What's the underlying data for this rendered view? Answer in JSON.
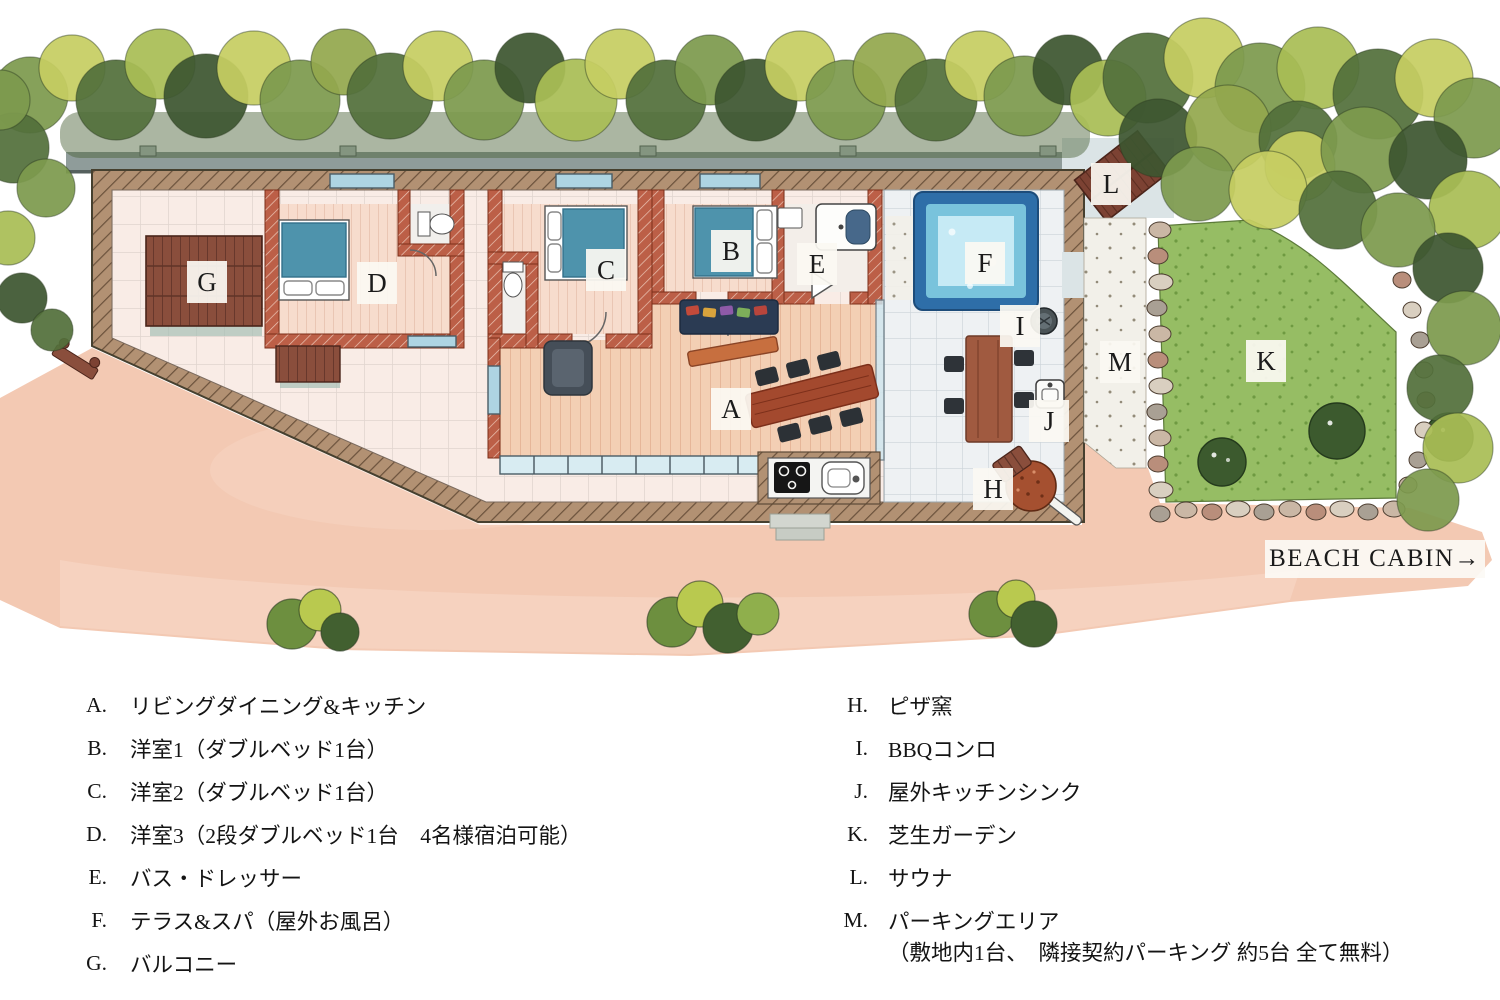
{
  "plan": {
    "labels": [
      {
        "letter": "A"
      },
      {
        "letter": "B"
      },
      {
        "letter": "C"
      },
      {
        "letter": "D"
      },
      {
        "letter": "E"
      },
      {
        "letter": "F"
      },
      {
        "letter": "G"
      },
      {
        "letter": "H"
      },
      {
        "letter": "I"
      },
      {
        "letter": "J"
      },
      {
        "letter": "K"
      },
      {
        "letter": "L"
      },
      {
        "letter": "M"
      }
    ],
    "beach_cabin": "BEACH CABIN→"
  },
  "legend": {
    "left": [
      {
        "letter": "A.",
        "text": "リビングダイニング&キッチン"
      },
      {
        "letter": "B.",
        "text": "洋室1（ダブルベッド1台）"
      },
      {
        "letter": "C.",
        "text": "洋室2（ダブルベッド1台）"
      },
      {
        "letter": "D.",
        "text": "洋室3（2段ダブルベッド1台　4名様宿泊可能）"
      },
      {
        "letter": "E.",
        "text": "バス・ドレッサー"
      },
      {
        "letter": "F.",
        "text": "テラス&スパ（屋外お風呂）"
      },
      {
        "letter": "G.",
        "text": "バルコニー"
      }
    ],
    "right": [
      {
        "letter": "H.",
        "text": "ピザ窯"
      },
      {
        "letter": "I.",
        "text": "BBQコンロ"
      },
      {
        "letter": "J.",
        "text": "屋外キッチンシンク"
      },
      {
        "letter": "K.",
        "text": "芝生ガーデン"
      },
      {
        "letter": "L.",
        "text": "サウナ"
      },
      {
        "letter": "M.",
        "text": "パーキングエリア",
        "note": "（敷地内1台、　隣接契約パーキング 約5台 全て無料）"
      }
    ]
  },
  "colors": {
    "spa_water": "#a5dcec",
    "spa_border": "#2e6ea8",
    "lawn": "#96bd64",
    "ground": "#f2c3ab",
    "deck_wood": "#8a4e3c",
    "bed_blue": "#4e93ac",
    "tree_light": "#c6cd62",
    "tree_dark": "#3d5630",
    "wall_brown": "#b29173",
    "wall_red": "#bc5f47"
  }
}
